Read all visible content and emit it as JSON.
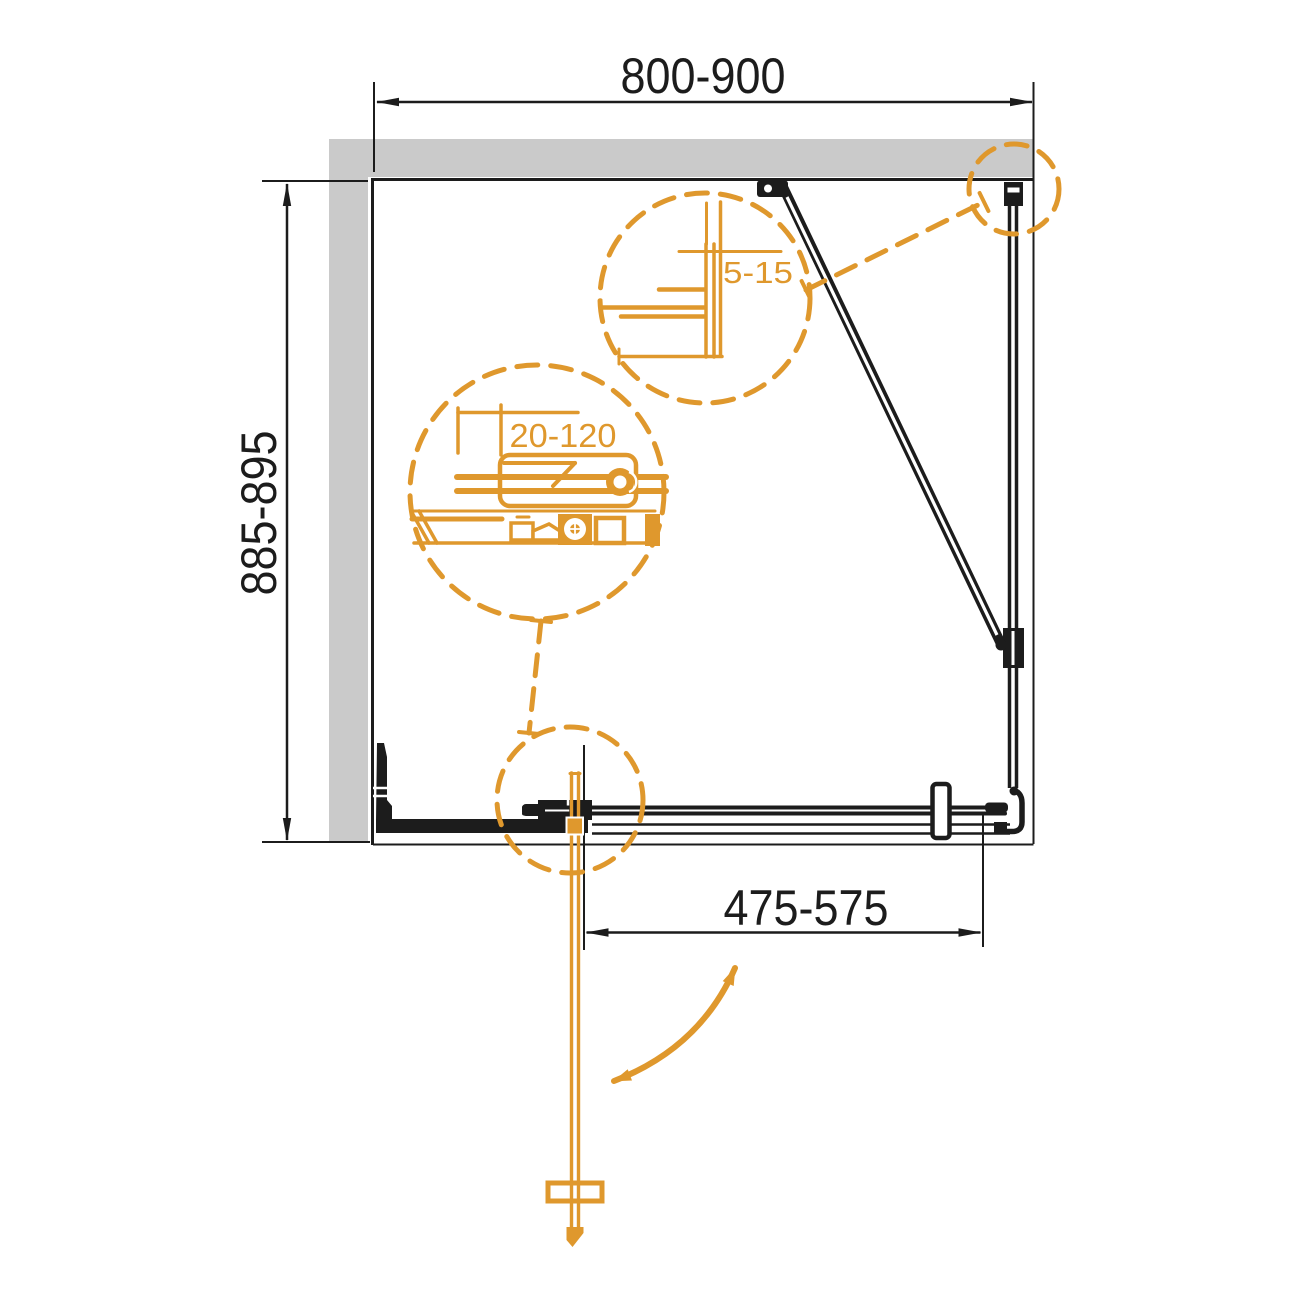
{
  "diagram": {
    "title": "shower-enclosure-top-view-installation-drawing",
    "labels": {
      "dim_top": "800-900",
      "dim_left": "885-895",
      "dim_bottom": "475-575",
      "detail_wall_profile": "5-15",
      "detail_adjustment": "20-120"
    },
    "colors": {
      "accent_orange": "#DF982D",
      "line_black": "#1C1C1C",
      "wall_gray": "#CACACA"
    }
  }
}
